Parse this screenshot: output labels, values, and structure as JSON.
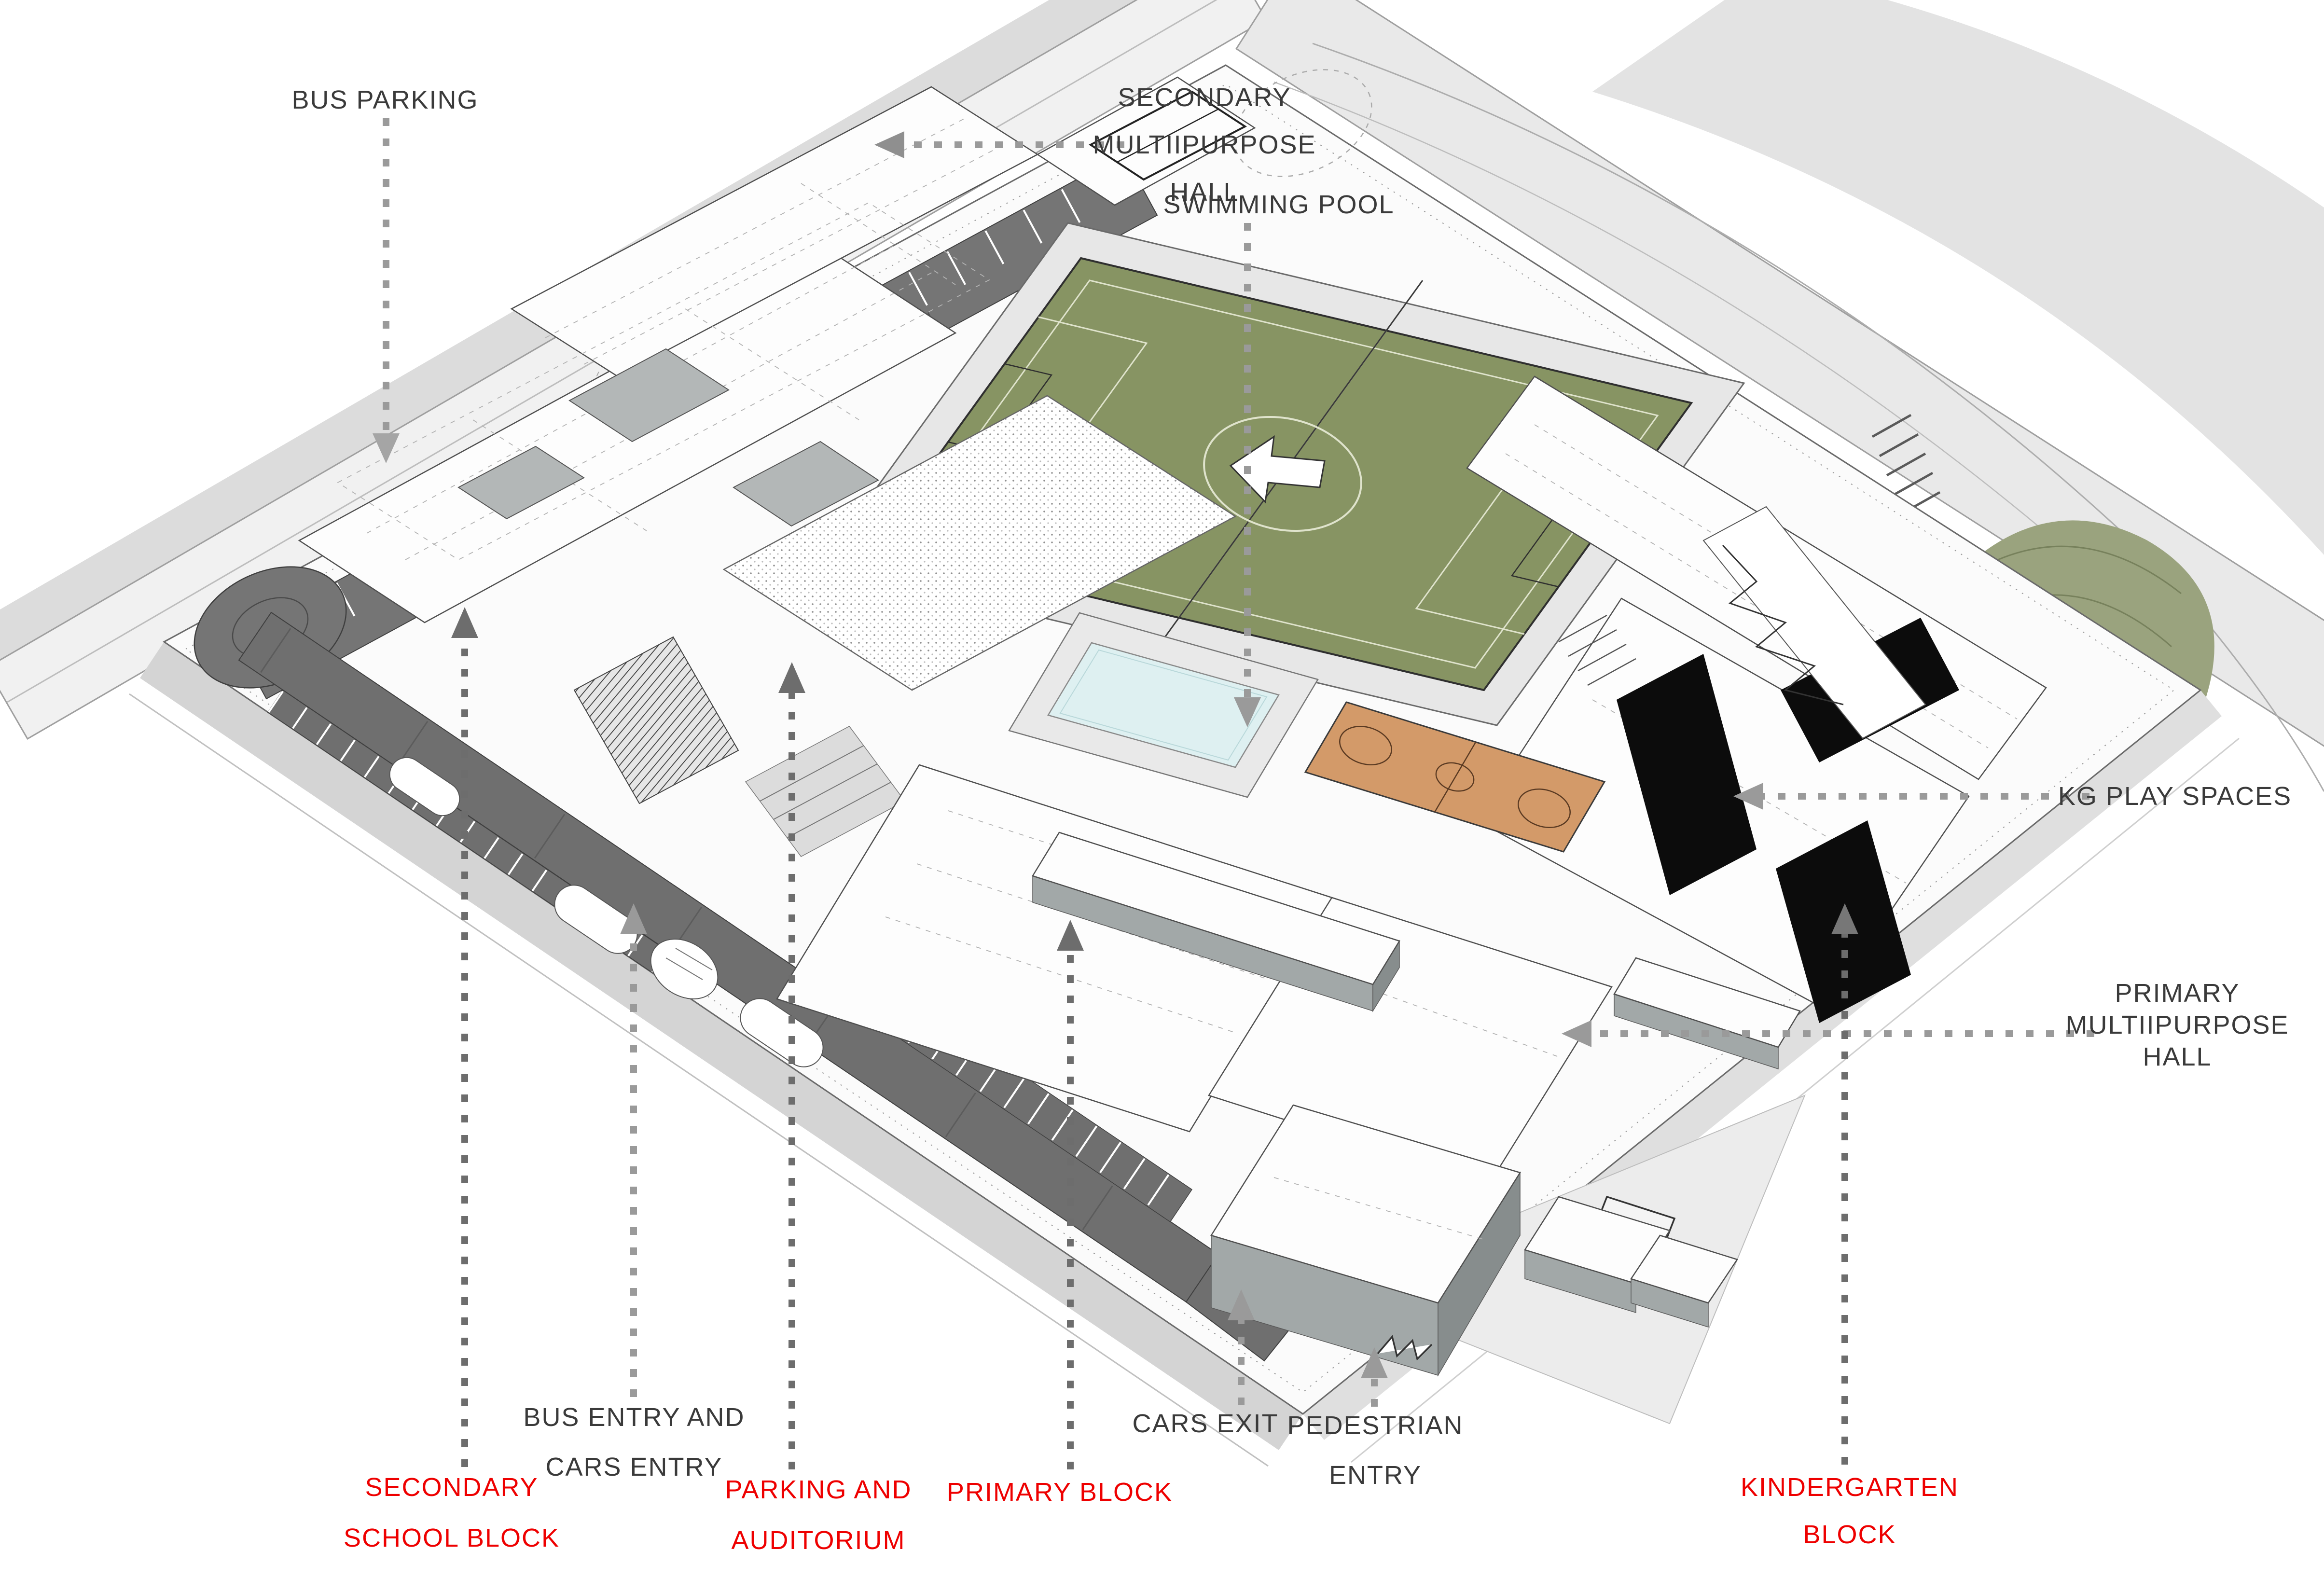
{
  "diagram": {
    "type": "axonometric-school-site-plan",
    "annotations": {
      "bus_parking": "BUS PARKING",
      "secondary_hall": {
        "l1": "SECONDARY",
        "l2": "MULTIIPURPOSE",
        "l3": "HALL"
      },
      "swimming_pool": "SWIMMING POOL",
      "kg_play_spaces": "KG PLAY SPACES",
      "primary_hall": {
        "l1": "PRIMARY",
        "l2": "MULTIIPURPOSE",
        "l3": "HALL"
      },
      "bus_entry": {
        "l1": "BUS ENTRY AND",
        "l2": "CARS ENTRY"
      },
      "cars_exit": "CARS EXIT",
      "pedestrian_entry": {
        "l1": "PEDESTRIAN",
        "l2": "ENTRY"
      },
      "secondary_block": {
        "l1": "SECONDARY",
        "l2": "SCHOOL BLOCK"
      },
      "parking_auditorium": {
        "l1": "PARKING AND",
        "l2": "AUDITORIUM"
      },
      "primary_block": "PRIMARY BLOCK",
      "kindergarten_block": {
        "l1": "KINDERGARTEN",
        "l2": "BLOCK"
      }
    },
    "colors": {
      "label_dark": "#3a3a3a",
      "label_red": "#ee0000",
      "leader_gray": "#9a9a9a",
      "field_green": "#879463",
      "pool_blue": "#def0f1",
      "court_orange": "#d39a69",
      "road_dark": "#6f6f6f",
      "play_space_black": "#0c0c0c",
      "median_yellow": "#d6d23f",
      "landscape_green": "#9aa37e"
    }
  }
}
